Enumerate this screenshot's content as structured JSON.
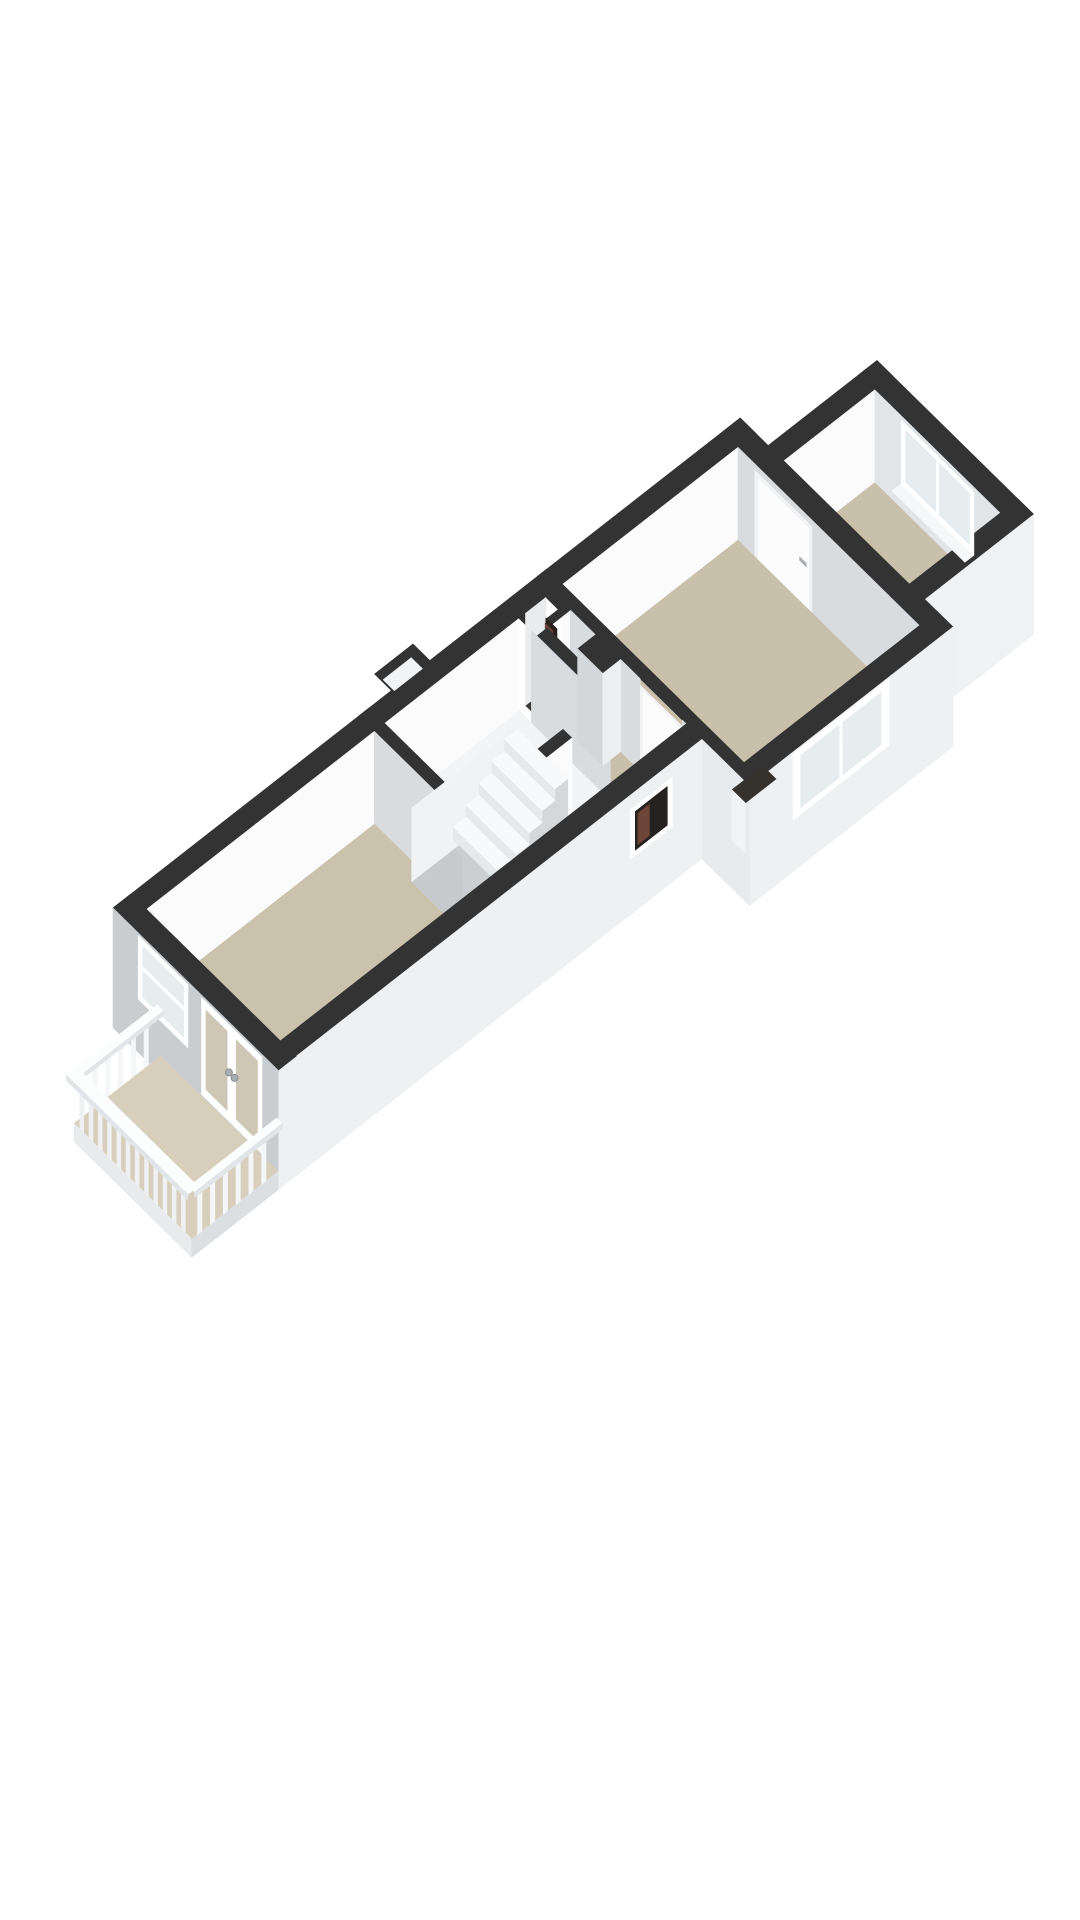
{
  "page": {
    "background": "#ffffff",
    "type": "3d-floor-plan-render",
    "text_content": "none"
  },
  "colors": {
    "bg": "#ffffff",
    "top": "#333333",
    "innLit": "#fbfbfc",
    "innShade": "#d9dcdf",
    "innShade2": "#e2e5e8",
    "innMid": "#e9ebed",
    "extSE": "#eef0f2",
    "extSW": "#c9cdd0",
    "extSW2": "#e8ebed",
    "extTR": "#eff1f2",
    "floor": "#c9c0ac",
    "floorLiving": "#cbc2ae",
    "floorStair": "#f3f4f5",
    "floorBalcony": "#d7cfbc",
    "frame": "#ffffff",
    "glass": "#e7ecef",
    "glassBeige": "#cfc7b6",
    "sill": "#f6f7f8",
    "leaf": "#fcfcfd",
    "leafFrame": "#f1f2f3",
    "hw": "#a9aeb2",
    "dark": "#262220",
    "shaftFloor": "#403a34",
    "heater": "#6e4539",
    "heaterDark": "#2a211d",
    "tread": "#f8f9fa",
    "riser": "#e6e9eb",
    "stepSide": "#d4d8db",
    "wellBottom": "#cbcfd2",
    "wellSW": "#c6cacd",
    "wellNW": "#f0f2f4",
    "railLit": "#f4f6f7",
    "railFace": "#eff1f2",
    "railTop": "#fcfdfd",
    "railEdge": "#e2e5e7",
    "fascia": "#e8eaeb",
    "fasciaSide": "#dcdfe2",
    "bumpInset": "#f2f3f4",
    "colSW": "#d4d7da",
    "colSE": "#eceef0",
    "niche": "#35312d",
    "nicheFace": "#f1f3f4",
    "knob": "#e9ebec",
    "knobStroke": "#8d9296"
  },
  "scene": {
    "rooms": [
      {
        "id": "living-room",
        "floor": "floorLiving"
      },
      {
        "id": "stair-hall",
        "floor": "floorStair"
      },
      {
        "id": "landing-hall",
        "floor": "floor"
      },
      {
        "id": "main-room",
        "floor": "floor"
      },
      {
        "id": "rear-room",
        "floor": "floor"
      }
    ],
    "features": [
      "balcony",
      "balcony-railing",
      "french-doors",
      "sw-window",
      "se-window",
      "small-dark-window",
      "rear-window",
      "staircase",
      "stairwell",
      "interior-doors",
      "duct-shaft",
      "heater-unit",
      "chimney-column",
      "chimney-niche",
      "wall-niche"
    ],
    "staircase_steps": 5,
    "railing_slats": {
      "front": 12,
      "nw_side": 6,
      "se_side": 6
    }
  }
}
